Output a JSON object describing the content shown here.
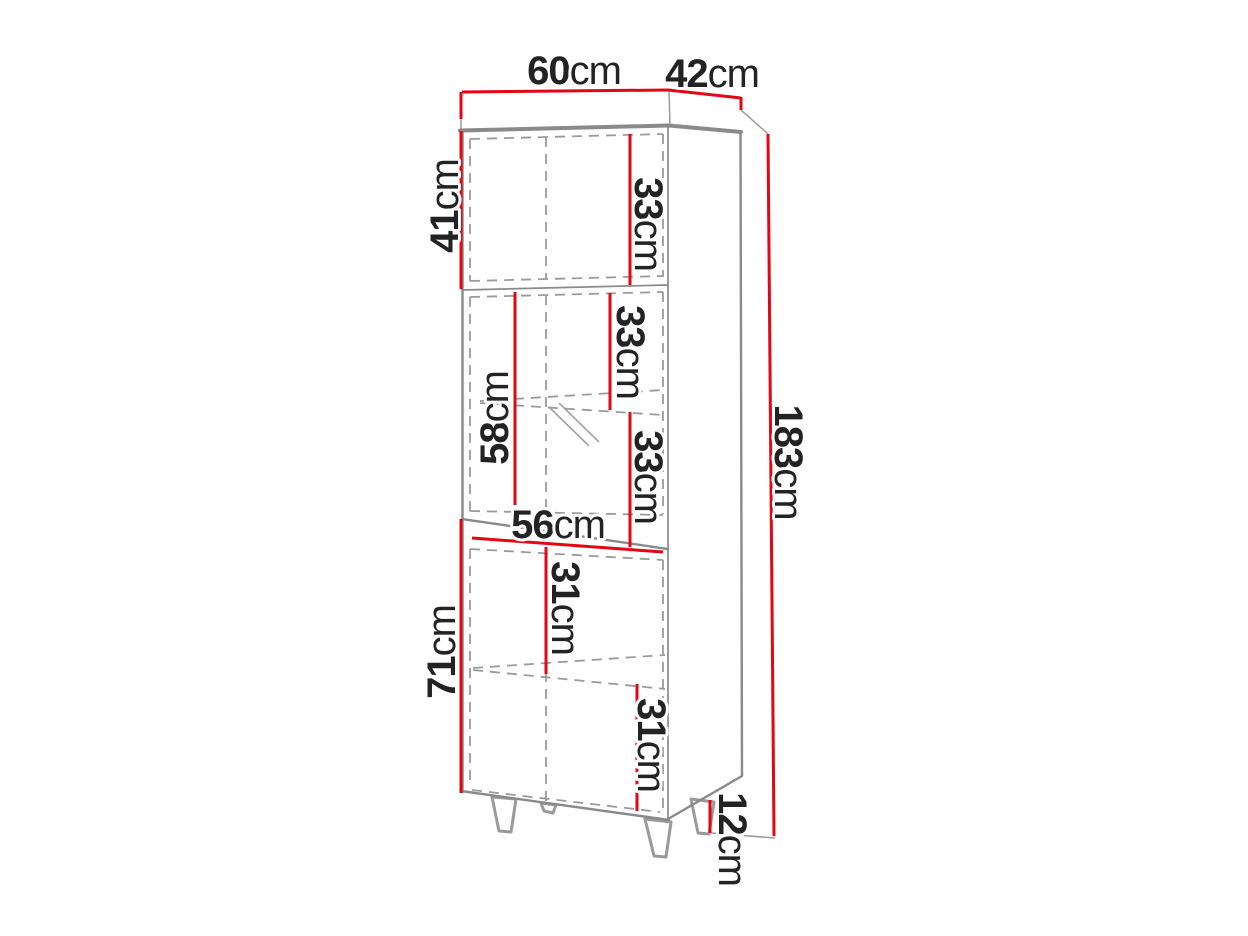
{
  "diagram": {
    "subject": "tall-cabinet-dimension-drawing",
    "colors": {
      "dimension_red": "#e30613",
      "edge_gray": "#8a8a8a",
      "hidden_gray": "#9b9b9b",
      "label_text": "#232323",
      "background": "#ffffff"
    },
    "dimensions": {
      "top_width": {
        "value": "60",
        "unit": "cm"
      },
      "top_depth": {
        "value": "42",
        "unit": "cm"
      },
      "upper_door_height": {
        "value": "41",
        "unit": "cm"
      },
      "upper_inner_height": {
        "value": "33",
        "unit": "cm"
      },
      "glass_upper_inner": {
        "value": "33",
        "unit": "cm"
      },
      "glass_door_height": {
        "value": "58",
        "unit": "cm"
      },
      "glass_lower_inner": {
        "value": "33",
        "unit": "cm"
      },
      "inner_width": {
        "value": "56",
        "unit": "cm"
      },
      "lower_upper_inner": {
        "value": "31",
        "unit": "cm"
      },
      "lower_door_height": {
        "value": "71",
        "unit": "cm"
      },
      "lower_lower_inner": {
        "value": "31",
        "unit": "cm"
      },
      "total_height": {
        "value": "183",
        "unit": "cm"
      },
      "leg_height": {
        "value": "12",
        "unit": "cm"
      }
    }
  }
}
